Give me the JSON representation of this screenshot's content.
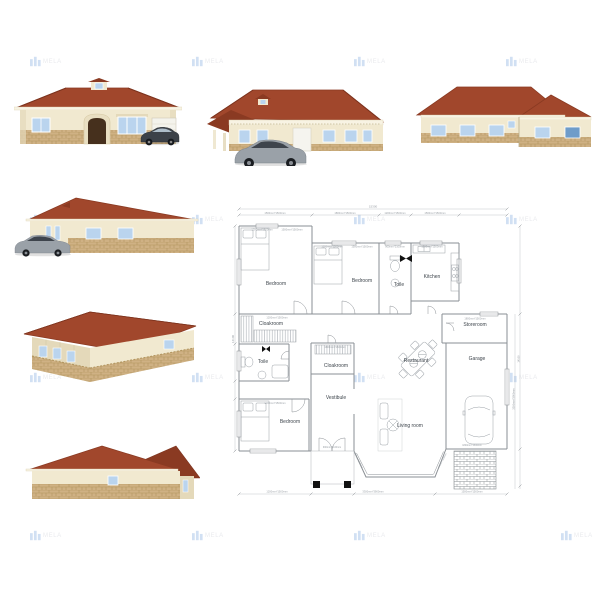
{
  "watermark": {
    "text": "MELA"
  },
  "colors": {
    "roof": "#a1472c",
    "roof_dark": "#8a3a22",
    "wall": "#f1e9d0",
    "wall_shade": "#e4d9ba",
    "cornice": "#f8f3e3",
    "stone": "#cfb184",
    "stone_dark": "#b2955f",
    "window": "#bad4ee",
    "window_dark": "#6f9cc9",
    "frame": "#ffffff",
    "door": "#46301d",
    "garage_door": "#f4f3ec",
    "car_dark": "#3c4148",
    "car_silver": "#9aa1a8",
    "plan_line": "#8a8f94",
    "plan_text": "#3f464d",
    "dim_text": "#9aa0a6",
    "watermark": "#8fb4e3",
    "watermark_text": "#c9ccd4"
  },
  "floor_plan": {
    "rooms": [
      {
        "label": "Bedroom"
      },
      {
        "label": "Bedroom"
      },
      {
        "label": "Toile"
      },
      {
        "label": "Kitchen"
      },
      {
        "label": "Cloakroom"
      },
      {
        "label": "Toile"
      },
      {
        "label": "Cloakroom"
      },
      {
        "label": "Restaurant"
      },
      {
        "label": "Storeroom"
      },
      {
        "label": "Garage"
      },
      {
        "label": "Vestibule"
      },
      {
        "label": "Bedroom"
      },
      {
        "label": "Living room"
      }
    ],
    "dims": {
      "overall_width": "15300",
      "overall_depth": "14100",
      "dim_a": "1500mm*1500mm",
      "dim_b": "1200mm*1500mm",
      "dim_c": "1800mm*1500mm",
      "dim_d": "900mm*2100mm",
      "dim_e": "3300mm*3900mm"
    }
  }
}
